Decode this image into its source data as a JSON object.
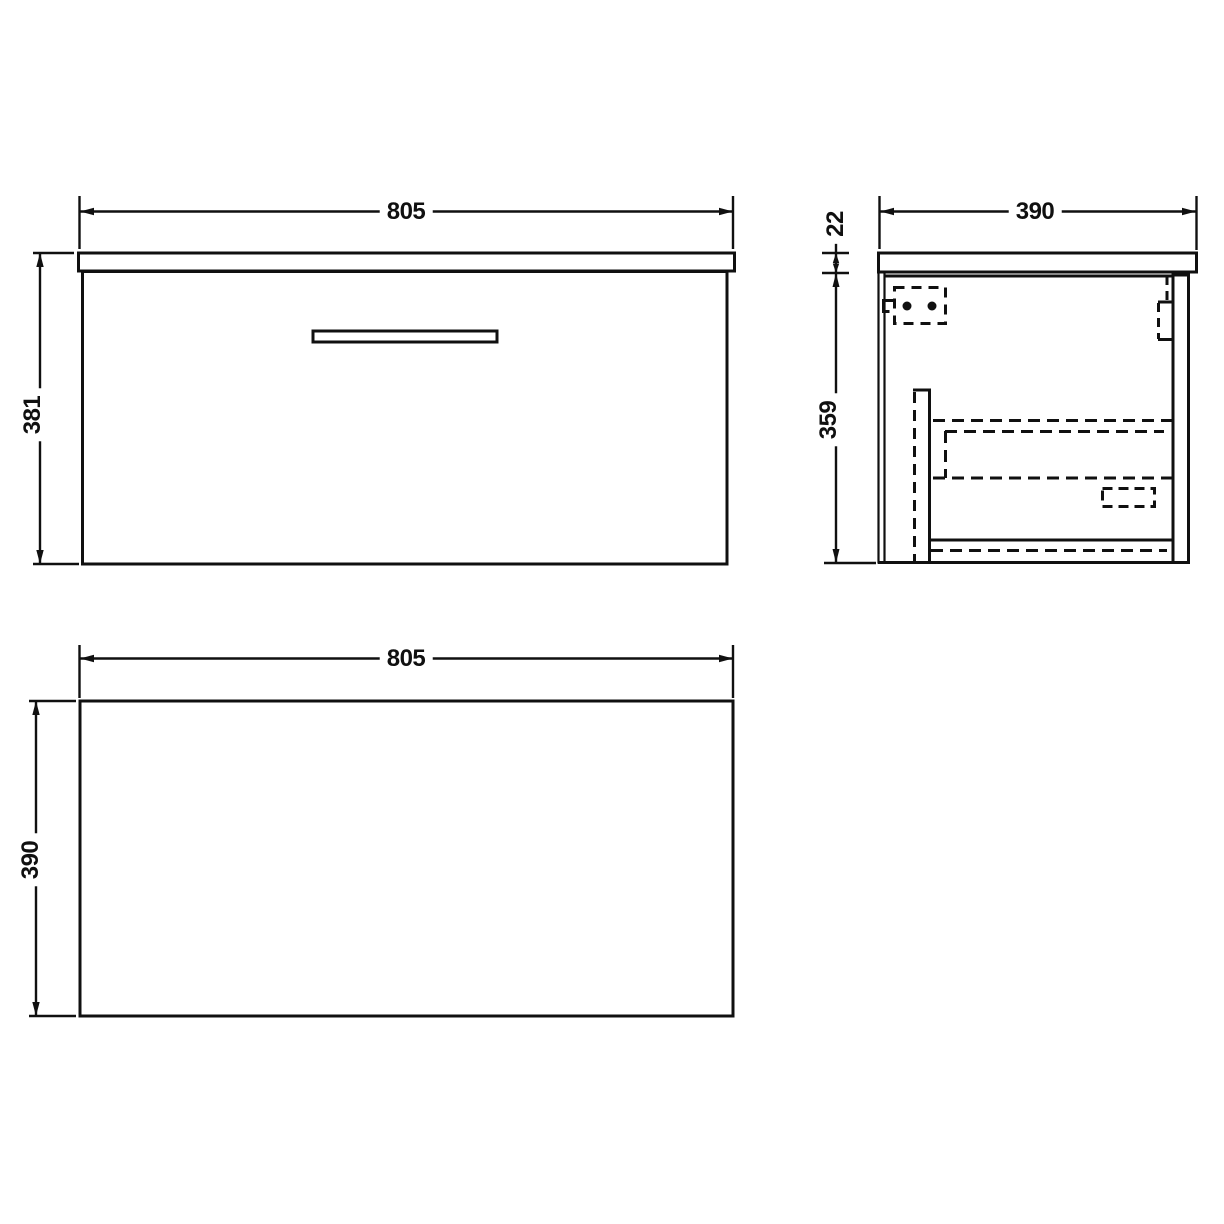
{
  "drawing": {
    "type": "technical-dimension-drawing",
    "subject": "wall-hung vanity unit with single drawer",
    "units_implied": "mm",
    "colors": {
      "line": "#101010",
      "background": "#ffffff"
    },
    "views": {
      "front": {
        "label": "front-view",
        "width": "805",
        "height": "381"
      },
      "side": {
        "label": "side-view",
        "depth": "390",
        "worktop_thickness": "22",
        "cabinet_height": "359"
      },
      "plan": {
        "label": "plan-view",
        "width": "805",
        "depth": "390"
      }
    }
  }
}
